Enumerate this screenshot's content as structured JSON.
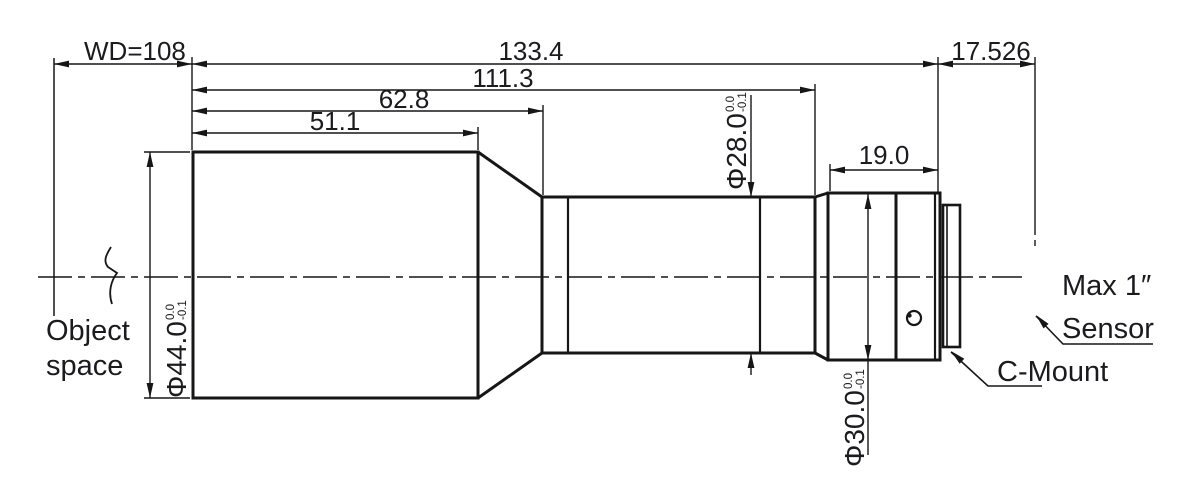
{
  "drawing": {
    "background": "#ffffff",
    "line_color": "#161616",
    "labels": {
      "wd": "WD=108",
      "total_length": "133.4",
      "len_to_rear_section": "111.3",
      "len_to_mid_barrel": "62.8",
      "len_front_barrel": "51.1",
      "rear_barrel_length": "19.0",
      "flange_focal_distance": "17.526",
      "object_space_line1": "Object",
      "object_space_line2": "space",
      "sensor_note_line1": "Max 1″",
      "sensor_note_line2": "Sensor",
      "c_mount": "C-Mount"
    },
    "diameters": {
      "front": {
        "value": "Φ44.0",
        "tol_upper": "0.0",
        "tol_lower": "-0.1"
      },
      "mid": {
        "value": "Φ28.0",
        "tol_upper": "0.0",
        "tol_lower": "-0.1"
      },
      "rear": {
        "value": "Φ30.0",
        "tol_upper": "0.0",
        "tol_lower": "-0.1"
      }
    }
  }
}
